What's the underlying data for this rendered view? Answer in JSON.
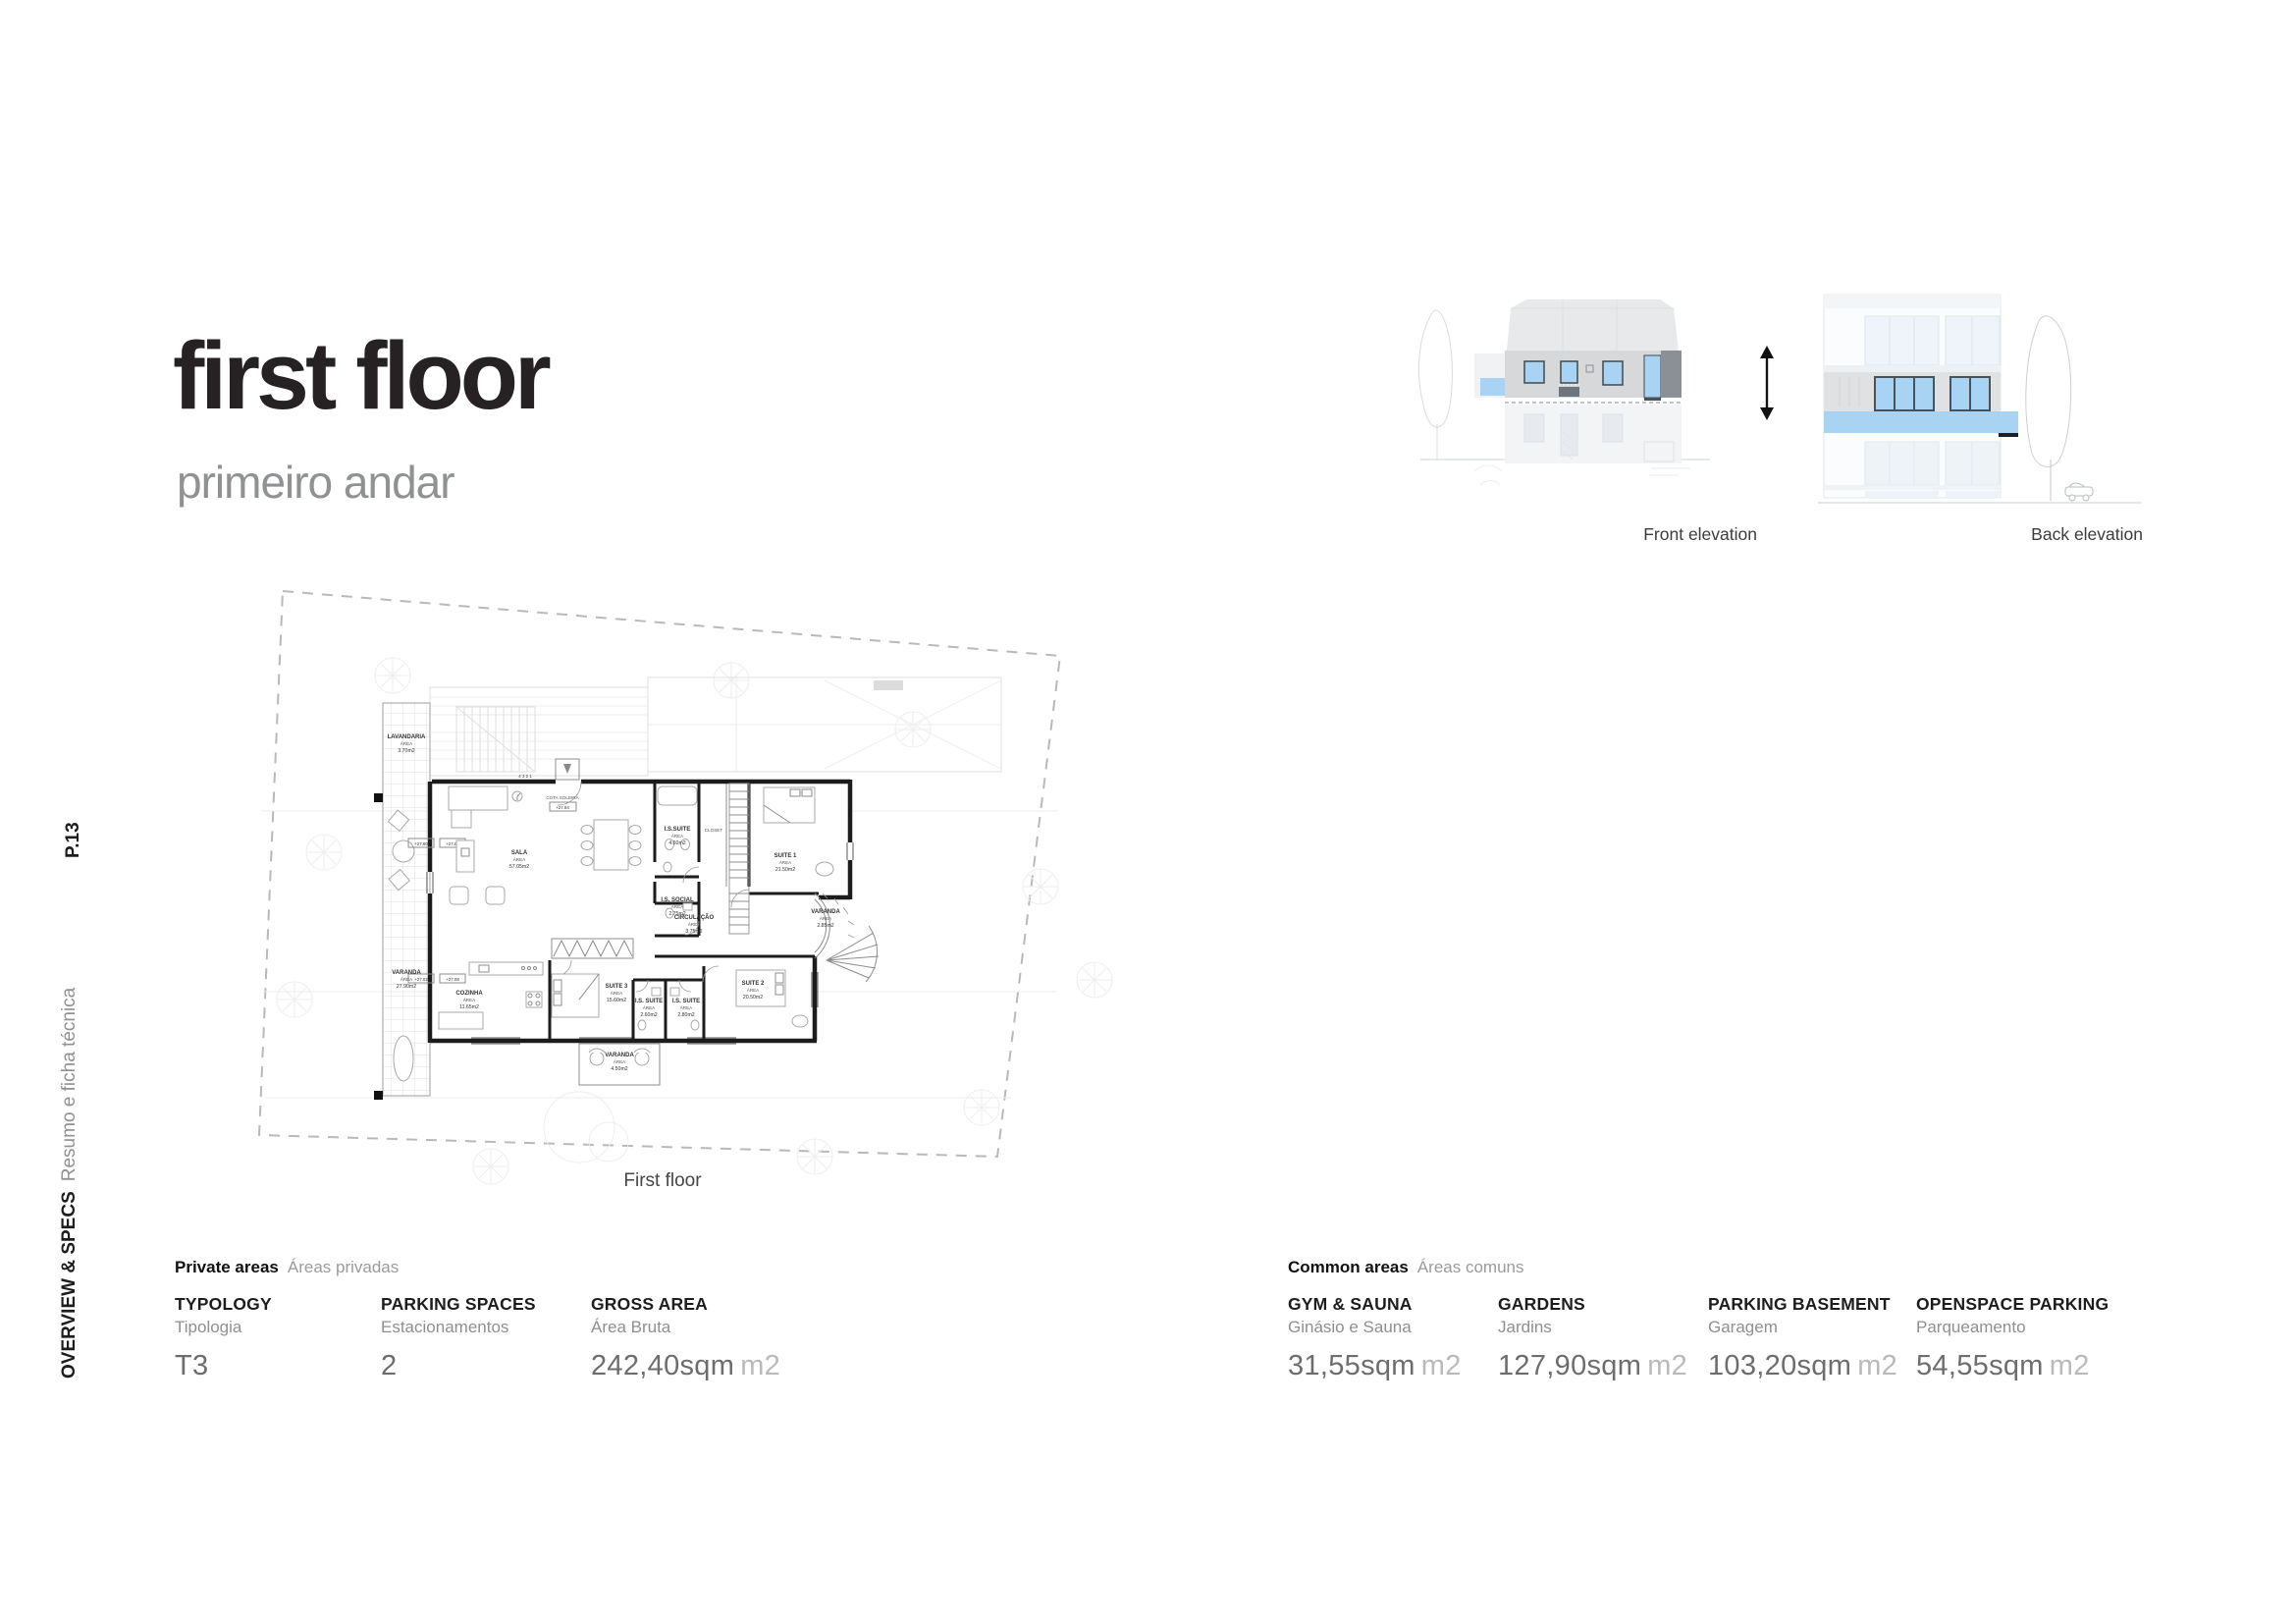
{
  "page": {
    "title": "first floor",
    "subtitle": "primeiro andar",
    "page_number": "P.13",
    "section_label": "OVERVIEW & SPECS",
    "section_sublabel": "Resumo e ficha técnica"
  },
  "elevations": {
    "front_label": "Front elevation",
    "back_label": "Back elevation"
  },
  "floor_plan": {
    "caption": "First floor",
    "area_word": "ÁREA",
    "cota_label": "COTA SOLEIRA",
    "cota_value": "+27.94",
    "stair_numbers": "4 3 2 1",
    "level_markers": [
      "+27.60",
      "+27.06",
      "+27.02",
      "+27.08"
    ],
    "rooms": [
      {
        "name": "LAVANDARIA",
        "area": "3.70m2"
      },
      {
        "name": "VARANDA",
        "area": "27.90m2"
      },
      {
        "name": "SALA",
        "area": "57.05m2"
      },
      {
        "name": "I.S.SUITE",
        "area": "4.60m2"
      },
      {
        "name": "CLOSET",
        "area": ""
      },
      {
        "name": "SUITE 1",
        "area": "21.50m2"
      },
      {
        "name": "I.S. SOCIAL",
        "area": "2.75m2"
      },
      {
        "name": "CIRCULAÇÃO",
        "area": "3.75m2"
      },
      {
        "name": "VARANDA",
        "area": "2.85m2"
      },
      {
        "name": "COZINHA",
        "area": "11.65m2"
      },
      {
        "name": "SUITE 3",
        "area": "15.60m2"
      },
      {
        "name": "I.S. SUITE",
        "area": "2.60m2"
      },
      {
        "name": "I.S. SUITE",
        "area": "2.80m2"
      },
      {
        "name": "SUITE 2",
        "area": "20.50m2"
      },
      {
        "name": "VARANDA",
        "area": "4.50m2"
      }
    ]
  },
  "private_areas": {
    "header": "Private areas",
    "header_alt": "Áreas privadas",
    "items": [
      {
        "label": "TYPOLOGY",
        "label_alt": "Tipologia",
        "value": "T3",
        "unit": ""
      },
      {
        "label": "PARKING SPACES",
        "label_alt": "Estacionamentos",
        "value": "2",
        "unit": ""
      },
      {
        "label": "GROSS AREA",
        "label_alt": "Área Bruta",
        "value": "242,40sqm",
        "unit": "m2"
      }
    ]
  },
  "common_areas": {
    "header": "Common areas",
    "header_alt": "Áreas comuns",
    "items": [
      {
        "label": "GYM & SAUNA",
        "label_alt": "Ginásio e Sauna",
        "value": "31,55sqm",
        "unit": "m2"
      },
      {
        "label": "GARDENS",
        "label_alt": "Jardins",
        "value": "127,90sqm",
        "unit": "m2"
      },
      {
        "label": "PARKING BASEMENT",
        "label_alt": "Garagem",
        "value": "103,20sqm",
        "unit": "m2"
      },
      {
        "label": "OPENSPACE PARKING",
        "label_alt": "Parqueamento",
        "value": "54,55sqm",
        "unit": "m2"
      }
    ]
  },
  "colors": {
    "accent_blue": "#a9d3f2",
    "elevation_band_gray": "#d7d8da",
    "elevation_dark_gray": "#8a9096",
    "text_dark": "#262122",
    "text_gray": "#8f9193",
    "value_gray": "#6d6d6d",
    "unit_gray": "#b9babc"
  }
}
